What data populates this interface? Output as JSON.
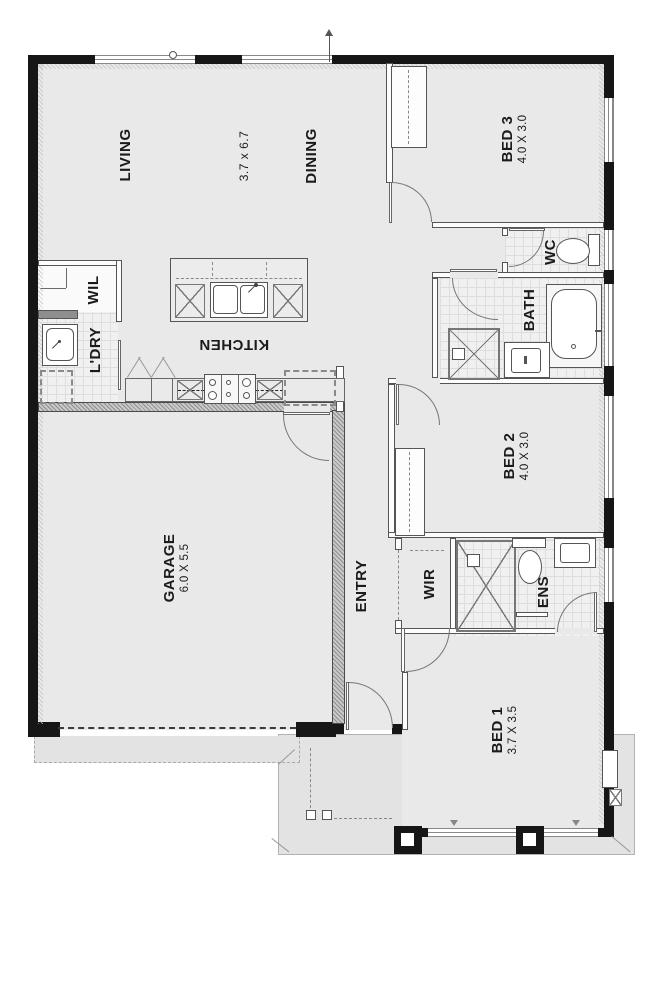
{
  "plan": {
    "type": "residential-floor-plan",
    "rooms": {
      "living": {
        "name": "LIVING",
        "dims": "3.7 x 6.7"
      },
      "dining": {
        "name": "DINING"
      },
      "kitchen": {
        "name": "KITCHEN"
      },
      "wil": {
        "name": "WIL"
      },
      "ldry": {
        "name": "L'DRY"
      },
      "bed3": {
        "name": "BED 3",
        "dims": "4.0 X 3.0"
      },
      "wc": {
        "name": "WC"
      },
      "bath": {
        "name": "BATH"
      },
      "bed2": {
        "name": "BED 2",
        "dims": "4.0 X 3.0"
      },
      "garage": {
        "name": "GARAGE",
        "dims": "6.0 X 5.5"
      },
      "entry": {
        "name": "ENTRY"
      },
      "wir": {
        "name": "WIR"
      },
      "ens": {
        "name": "ENS"
      },
      "bed1": {
        "name": "BED 1",
        "dims": "3.7 X 3.5"
      }
    },
    "colors": {
      "wall": "#161616",
      "floor": "#e9e9e9",
      "tile": "#f0f0f0",
      "outdoor": "#e3e3e3",
      "line": "#666666"
    }
  }
}
